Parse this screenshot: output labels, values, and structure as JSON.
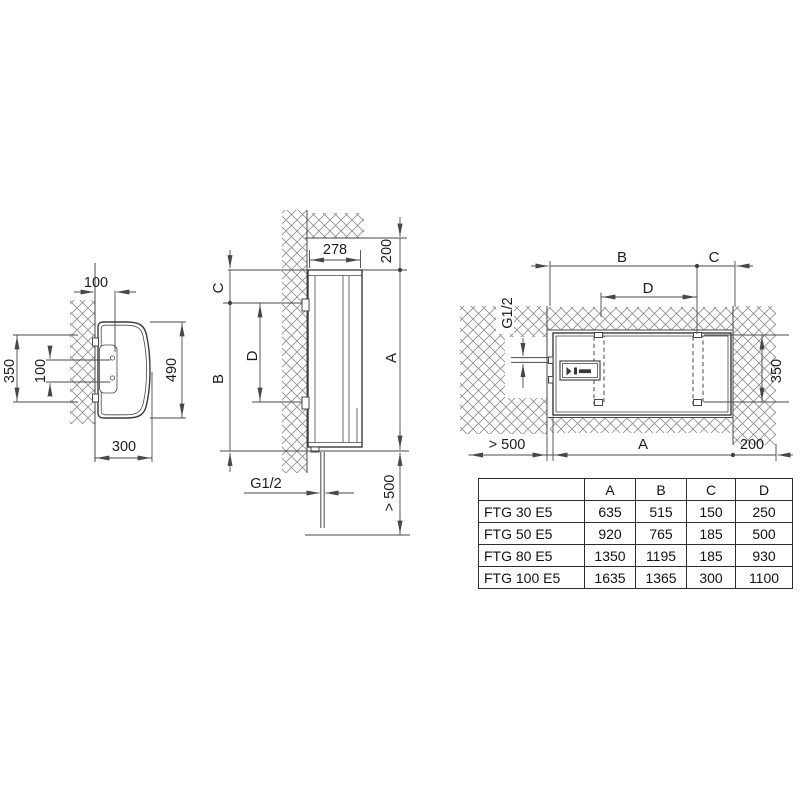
{
  "colors": {
    "line": "#474747",
    "hatch": "#8f8f8f",
    "text": "#1c1c1c",
    "background": "#ffffff"
  },
  "left_view": {
    "wall_offset": "100",
    "hole_spacing": "100",
    "bracket_span": "350",
    "height": "490",
    "depth": "300"
  },
  "front_view": {
    "width": "278",
    "ceiling_clearance": "200",
    "dim_c": "C",
    "dim_d": "D",
    "dim_b": "B",
    "dim_a": "A",
    "pipe_thread": "G1/2",
    "floor_clearance": "> 500"
  },
  "horizontal_view": {
    "dim_b": "B",
    "dim_c": "C",
    "dim_d": "D",
    "pipe_thread": "G1/2",
    "bracket_span": "350",
    "front_clearance": "> 500",
    "dim_a": "A",
    "side_clearance": "200"
  },
  "table": {
    "headers": [
      "",
      "A",
      "B",
      "C",
      "D"
    ],
    "rows": [
      {
        "model": "FTG 30 E5",
        "values": [
          "635",
          "515",
          "150",
          "250"
        ]
      },
      {
        "model": "FTG 50 E5",
        "values": [
          "920",
          "765",
          "185",
          "500"
        ]
      },
      {
        "model": "FTG 80 E5",
        "values": [
          "1350",
          "1195",
          "185",
          "930"
        ]
      },
      {
        "model": "FTG 100 E5",
        "values": [
          "1635",
          "1365",
          "300",
          "1100"
        ]
      }
    ]
  }
}
